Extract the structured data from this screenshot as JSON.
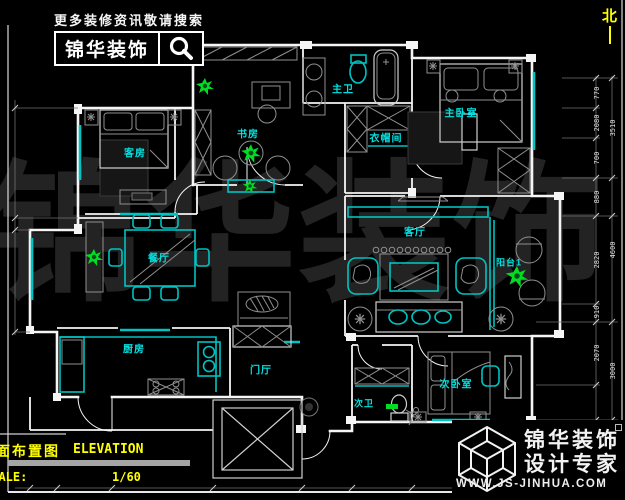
{
  "header": {
    "search_note": "更多装修资讯敬请搜索",
    "brand": "锦华装饰",
    "search_icon": "magnifier-icon"
  },
  "compass": {
    "label": "北"
  },
  "watermark": "锦华装饰",
  "rooms": [
    {
      "id": "study",
      "label": "书房",
      "x": 248,
      "y": 133,
      "small": false
    },
    {
      "id": "master-bath",
      "label": "主卫",
      "x": 343,
      "y": 88,
      "small": false
    },
    {
      "id": "closet",
      "label": "衣帽间",
      "x": 386,
      "y": 137,
      "small": false
    },
    {
      "id": "master-bedroom",
      "label": "主卧室",
      "x": 461,
      "y": 112,
      "small": false
    },
    {
      "id": "guest-room",
      "label": "客房",
      "x": 135,
      "y": 152,
      "small": false
    },
    {
      "id": "dining",
      "label": "餐厅",
      "x": 159,
      "y": 257,
      "small": false
    },
    {
      "id": "living",
      "label": "客厅",
      "x": 415,
      "y": 231,
      "small": false
    },
    {
      "id": "balcony",
      "label": "阳台1",
      "x": 509,
      "y": 262,
      "small": true
    },
    {
      "id": "kitchen",
      "label": "厨房",
      "x": 134,
      "y": 348,
      "small": false
    },
    {
      "id": "foyer",
      "label": "门厅",
      "x": 261,
      "y": 369,
      "small": false
    },
    {
      "id": "second-bath",
      "label": "次卫",
      "x": 364,
      "y": 403,
      "small": true
    },
    {
      "id": "second-bedroom",
      "label": "次卧室",
      "x": 456,
      "y": 383,
      "small": false
    }
  ],
  "dimensions": {
    "right_segments": [
      {
        "value": "770",
        "y": 93
      },
      {
        "value": "2080",
        "y": 123
      },
      {
        "value": "700",
        "y": 158
      },
      {
        "value": "880",
        "y": 197
      },
      {
        "value": "2820",
        "y": 260
      },
      {
        "value": "910",
        "y": 312
      },
      {
        "value": "2070",
        "y": 353
      }
    ],
    "right_totals": [
      {
        "value": "3510",
        "y": 128
      },
      {
        "value": "4600",
        "y": 250
      },
      {
        "value": "3000",
        "y": 371
      }
    ]
  },
  "title_block": {
    "drawing_name_cn": "平面布置图",
    "drawing_name_en": "ELEVATION",
    "scale_label": "SCALE:",
    "scale_value": "1/60"
  },
  "footer_logo": {
    "brand_line1": "锦华装饰",
    "brand_line2": "设计专家",
    "website": "WWW.JS-JINHUA.COM"
  },
  "colors": {
    "background": "#000000",
    "wall": "#f5f5f5",
    "cyan": "#00c3c3",
    "label": "#00e0e0",
    "yellow": "#ffff00",
    "green": "#00dd22",
    "gray": "#8f8f8f",
    "watermark": "#232323",
    "dim_text": "#e0e0e0",
    "title_bar": "#a5a5a5"
  }
}
